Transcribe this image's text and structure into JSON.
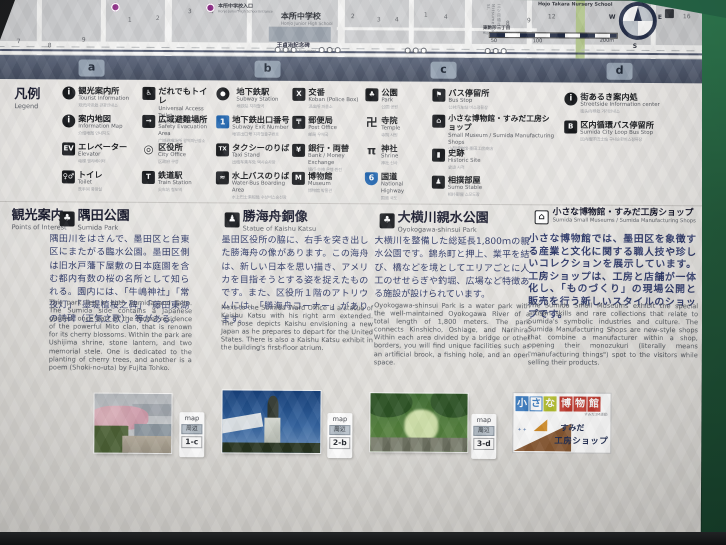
{
  "colors": {
    "frame_green": "#266647",
    "band_slate": "#4b5568",
    "metro_purple": "#8d2c86",
    "highway_blue": "#1d63ae",
    "jp_text_navy": "#2b3666",
    "logo_blue": "#3a7cc2",
    "logo_green": "#b7c22f",
    "logo_red": "#c43a2f",
    "logo_brown": "#8a5a33"
  },
  "map": {
    "nums": [
      "1",
      "2",
      "3",
      "4",
      "5",
      "7",
      "8",
      "9",
      "2",
      "3",
      "4",
      "1",
      "4",
      "8",
      "9",
      "12",
      "16"
    ],
    "school_entrance": "本所中学校入口",
    "school_entrance_en": "Honjo Junior High School Entrance",
    "school": "本所中学校",
    "school_en": "Honjo Junior High School",
    "monument": "王貞治記念碑",
    "monument_en": "Sadaharu Oh Monument",
    "crossing": "東駒形三丁目",
    "crossing_en": "Higashi-Komagata",
    "nursery_en": "Hojo Takara Nursery School",
    "street_en": "三ツ目通り Mitsume-dori St.",
    "scale": [
      "50",
      "100",
      "200m"
    ],
    "compass": {
      "w": "W",
      "s": "S",
      "e": "E"
    }
  },
  "tabs": [
    "a",
    "b",
    "c",
    "d"
  ],
  "legend": {
    "title_jp": "凡例",
    "title_en": "Legend",
    "columns": [
      {
        "items": [
          {
            "glyph": "i",
            "jp": "観光案内所",
            "en": "Tourist Information",
            "sub": "观光问讯处 관광안내소"
          },
          {
            "glyph": "i",
            "jp": "案内地図",
            "en": "Information Map",
            "sub": "介绍地图 안내지도"
          },
          {
            "glyph": "EV",
            "jp": "エレベーター",
            "en": "Elevator",
            "sub": "电梯 엘리베이터"
          },
          {
            "glyph": "♀♂",
            "jp": "トイレ",
            "en": "Toilet",
            "sub": "洗手间 화장실"
          }
        ]
      },
      {
        "items": [
          {
            "glyph": "♿",
            "jp": "だれでもトイレ",
            "en": "Universal Access Toilet",
            "sub": "多功能洗手间 다목적화장실"
          },
          {
            "glyph": "→",
            "jp": "広域避難場所",
            "en": "Safety Evacuation Area",
            "sub": "广域避难场所 광역피난장소"
          },
          {
            "glyph": "◎",
            "jp": "区役所",
            "en": "City Office",
            "sub": "区政府 구청"
          },
          {
            "glyph": "T",
            "jp": "鉄道駅",
            "en": "Train Station",
            "sub": "火车站 철도역"
          }
        ]
      },
      {
        "items": [
          {
            "glyph": "",
            "jp": "地下鉄駅",
            "en": "Subway Station",
            "sub": "地铁站 지하철역"
          },
          {
            "glyph": "1",
            "jp": "地下鉄出口番号",
            "en": "Subway Exit Number",
            "sub": "地铁出口号 지하철출구번호"
          },
          {
            "glyph": "TX",
            "jp": "タクシーのりば",
            "en": "Taxi Stand",
            "sub": "出租车乘车处 택시승차장"
          },
          {
            "glyph": "≈",
            "jp": "水上バスのりば",
            "en": "Water-Bus Boarding Area",
            "sub": "水上巴士乘船处 수상버스승선장"
          }
        ]
      },
      {
        "items": [
          {
            "glyph": "X",
            "jp": "交番",
            "en": "Koban (Police Box)",
            "sub": "派出所 파출소"
          },
          {
            "glyph": "〒",
            "jp": "郵便局",
            "en": "Post Office",
            "sub": "邮局 우체국"
          },
          {
            "glyph": "¥",
            "jp": "銀行・両替",
            "en": "Bank / Money Exchange",
            "sub": "银行·兑换 은행·환전"
          },
          {
            "glyph": "M",
            "jp": "博物館",
            "en": "Museum",
            "sub": "博物馆 박물관"
          }
        ]
      },
      {
        "items": [
          {
            "glyph": "♣",
            "jp": "公園",
            "en": "Park",
            "sub": "公园 공원"
          },
          {
            "glyph": "卍",
            "jp": "寺院",
            "en": "Temple",
            "sub": "寺院 사원"
          },
          {
            "glyph": "π",
            "jp": "神社",
            "en": "Shrine",
            "sub": "神社 신사"
          },
          {
            "glyph": "6",
            "jp": "国道",
            "en": "National Highway",
            "sub": "国道 국도"
          }
        ]
      },
      {
        "items": [
          {
            "glyph": "⚑",
            "jp": "バス停留所",
            "en": "Bus Stop",
            "sub": "公共汽车站 버스정류장"
          },
          {
            "glyph": "⌂",
            "jp": "小さな博物館・すみだ工房ショップ",
            "en": "Small Museum / Sumida Manufacturing Shops",
            "sub": "小型博物馆·墨田工房商店"
          },
          {
            "glyph": "▮",
            "jp": "史跡",
            "en": "Historic Site",
            "sub": "史迹 사적"
          },
          {
            "glyph": "♟",
            "jp": "相撲部屋",
            "en": "Sumo Stable",
            "sub": "相扑部屋 스모도장"
          }
        ]
      },
      {
        "items": [
          {
            "glyph": "i",
            "jp": "街あるき案内処",
            "en": "Streetside Information center",
            "sub": "街头向导处 거리안내소"
          },
          {
            "glyph": "B",
            "jp": "区内循環バス停留所",
            "en": "Sumida City Loop Bus Stop",
            "sub": "区内循环巴士站 구내순환버스정류장"
          }
        ]
      }
    ]
  },
  "content": {
    "poi_jp": "観光案内",
    "poi_en": "Points of Interest",
    "sections": [
      {
        "glyph": "♣",
        "title_jp": "隅田公園",
        "title_en": "Sumida Park",
        "jp": "隅田川をはさんで、墨田区と台東区にまたがる臨水公園。墨田区側は旧水戸藩下屋敷の日本庭園を含む都内有数の桜の名所として知られる。園内には、「牛嶋神社」「常夜灯」「墨堤植桜之碑」「藤田東湖の詩碑（正気之歌）」等がある。",
        "en": "This park lies in both Sumida and Taito. The Sumida side contains a Japanese garden, once part of the feudal residence of the powerful Mito clan, that is renown for its cherry blossoms. Within the park are Ushijima shrine, stone lantern, and two memorial stele. One is dedicated to the planting of cherry trees, and another is a poem (Shoki-no-uta) by Fujita Tohko."
      },
      {
        "glyph": "♟",
        "title_jp": "勝海舟銅像",
        "title_en": "Statue of Kaishu Katsu",
        "jp": "墨田区役所の脇に、右手を突き出した勝海舟の像があります。この海舟は、新しい日本を思い描き、アメリカを目指そうとする姿を捉えたものです。また、区役所１階のアトリウムには、「勝海舟コーナー」があります。",
        "en": "Next to the Sumida Ward Office is a statue of Kaishu Katsu with his right arm extended. The pose depicts Kaishu envisioning a new Japan as he prepares to depart for the United States. There is also a Kaishu Katsu exhibit in the building's first-floor atrium."
      },
      {
        "glyph": "♣",
        "title_jp": "大横川親水公園",
        "title_en": "Oyokogawa-shinsui Park",
        "jp": "大横川を整備した総延長1,800ｍの親水公園です。錦糸町と押上、業平を結び、橋などを境としてエリアごとに人工のせせらぎや釣堀、広場など特徴ある施設が設けられています。",
        "en": "Oyokogawa-shinsui Park is a water park with the well-maintained Oyokogawa River of a total length of 1,800 meters. The park connects Kinshicho, Oshiage, and Narihira. Within each area divided by a bridge or other borders, you will find unique facilities such as an artificial brook, a fishing hole, and an open space."
      },
      {
        "glyph": "⌂",
        "title_jp": "小さな博物館・すみだ工房ショップ",
        "title_en": "Sumida Small Museums / Sumida Manufacturing Shops",
        "jp": "小さな博物館では、墨田区を象徴する産業と文化に関する職人技や珍しいコレクションを展示しています。工房ショップは、工房と店舗が一体化し、「ものづくり」の現場公開と販売を行う新しいスタイルのショップです。",
        "en": "The Sumida Small Museums exhibit the special artisan skills and rare collections that relate to Sumida's symbolic industries and culture. The Sumida Manufacturing Shops are new-style shops that combine a manufacturer within a shop, opening their monozukuri (literally means \"manufacturing things\") spot to the visitors while selling their products."
      }
    ]
  },
  "footer": {
    "panels": [
      {
        "map": "map",
        "area": "周辺",
        "cell": "1-c"
      },
      {
        "map": "map",
        "area": "周辺",
        "cell": "2-b"
      },
      {
        "map": "map",
        "area": "周辺",
        "cell": "3-d"
      }
    ],
    "logo": {
      "tiles": [
        "小",
        "さ",
        "な",
        "博",
        "物",
        "館"
      ],
      "tagline": "すみだ3M運動",
      "brand1": "すみだ",
      "brand2": "工房ショップ"
    }
  }
}
